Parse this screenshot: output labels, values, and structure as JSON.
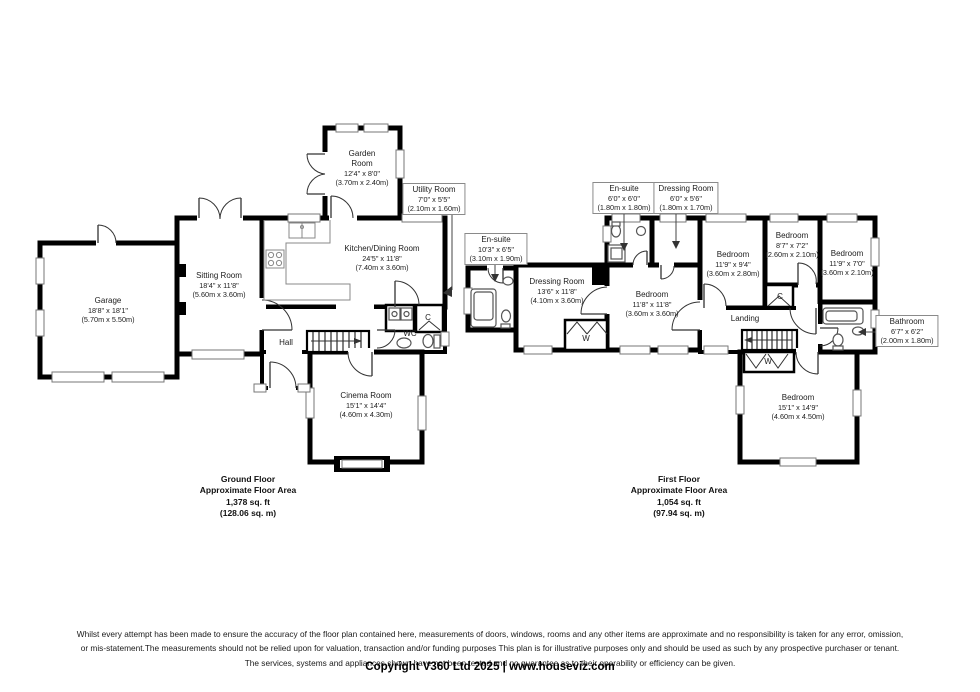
{
  "ground_floor": {
    "title": "Ground Floor",
    "subtitle": "Approximate Floor Area",
    "area_ft": "1,378 sq. ft",
    "area_m": "(128.06 sq. m)",
    "rooms": {
      "garage": {
        "name": "Garage",
        "dims_ft": "18'8\" x 18'1\"",
        "dims_m": "(5.70m x 5.50m)"
      },
      "sitting_room": {
        "name": "Sitting Room",
        "dims_ft": "18'4\" x 11'8\"",
        "dims_m": "(5.60m x 3.60m)"
      },
      "garden_room": {
        "name": "Garden Room",
        "dims_ft": "12'4\" x 8'0\"",
        "dims_m": "(3.70m x 2.40m)"
      },
      "kitchen_dining_room": {
        "name": "Kitchen/Dining Room",
        "dims_ft": "24'5\" x 11'8\"",
        "dims_m": "(7.40m x 3.60m)"
      },
      "utility_room": {
        "name": "Utility Room",
        "dims_ft": "7'0\" x 5'5\"",
        "dims_m": "(2.10m x 1.60m)"
      },
      "hall": {
        "name": "Hall"
      },
      "wc": {
        "name": "WC"
      },
      "cupboard": {
        "name": "C"
      },
      "cinema_room": {
        "name": "Cinema Room",
        "dims_ft": "15'1\" x 14'4\"",
        "dims_m": "(4.60m x 4.30m)"
      }
    }
  },
  "first_floor": {
    "title": "First Floor",
    "subtitle": "Approximate Floor Area",
    "area_ft": "1,054 sq. ft",
    "area_m": "(97.94 sq. m)",
    "rooms": {
      "en_suite_small": {
        "name": "En-suite",
        "dims_ft": "6'0\" x 6'0\"",
        "dims_m": "(1.80m x 1.80m)"
      },
      "dressing_room_small": {
        "name": "Dressing Room",
        "dims_ft": "6'0\" x 5'6\"",
        "dims_m": "(1.80m x 1.70m)"
      },
      "en_suite_large": {
        "name": "En-suite",
        "dims_ft": "10'3\" x 6'5\"",
        "dims_m": "(3.10m x 1.90m)"
      },
      "dressing_room_large": {
        "name": "Dressing Room",
        "dims_ft": "13'6\" x 11'8\"",
        "dims_m": "(4.10m x 3.60m)"
      },
      "bedroom_1": {
        "name": "Bedroom",
        "dims_ft": "11'8\" x 11'8\"",
        "dims_m": "(3.60m x 3.60m)"
      },
      "bedroom_2": {
        "name": "Bedroom",
        "dims_ft": "11'9\" x 9'4\"",
        "dims_m": "(3.60m x 2.80m)"
      },
      "bedroom_3": {
        "name": "Bedroom",
        "dims_ft": "8'7\" x 7'2\"",
        "dims_m": "(2.60m x 2.10m)"
      },
      "bedroom_4": {
        "name": "Bedroom",
        "dims_ft": "11'9\" x 7'0\"",
        "dims_m": "(3.60m x 2.10m)"
      },
      "bedroom_5": {
        "name": "Bedroom",
        "dims_ft": "15'1\" x 14'9\"",
        "dims_m": "(4.60m x 4.50m)"
      },
      "bathroom": {
        "name": "Bathroom",
        "dims_ft": "6'7\" x 6'2\"",
        "dims_m": "(2.00m x 1.80m)"
      },
      "landing": {
        "name": "Landing"
      },
      "cupboard": {
        "name": "C"
      },
      "wardrobe": {
        "name": "W"
      }
    }
  },
  "footer": {
    "disclaimer_line1": "Whilst every attempt has been made to ensure the accuracy of the floor plan contained here, measurements of doors, windows, rooms and any other items are approximate and no responsibility is taken for any error, omission,",
    "disclaimer_line2": "or mis-statement.The measurements should not be relied upon for valuation, transaction and/or funding purposes This plan is for illustrative purposes only and should be used as such by any prospective purchaser or tenant.",
    "disclaimer_line3": "The services, systems and appliances shown have not been tested and no guarantee as to their operability or efficiency can be given.",
    "copyright": "Copyright V360 Ltd 2025 | www.houseviz.com"
  },
  "colors": {
    "wall": "#000000",
    "window_frame": "#777777",
    "label_border": "#8a8a8a",
    "text": "#1c1c1c"
  }
}
